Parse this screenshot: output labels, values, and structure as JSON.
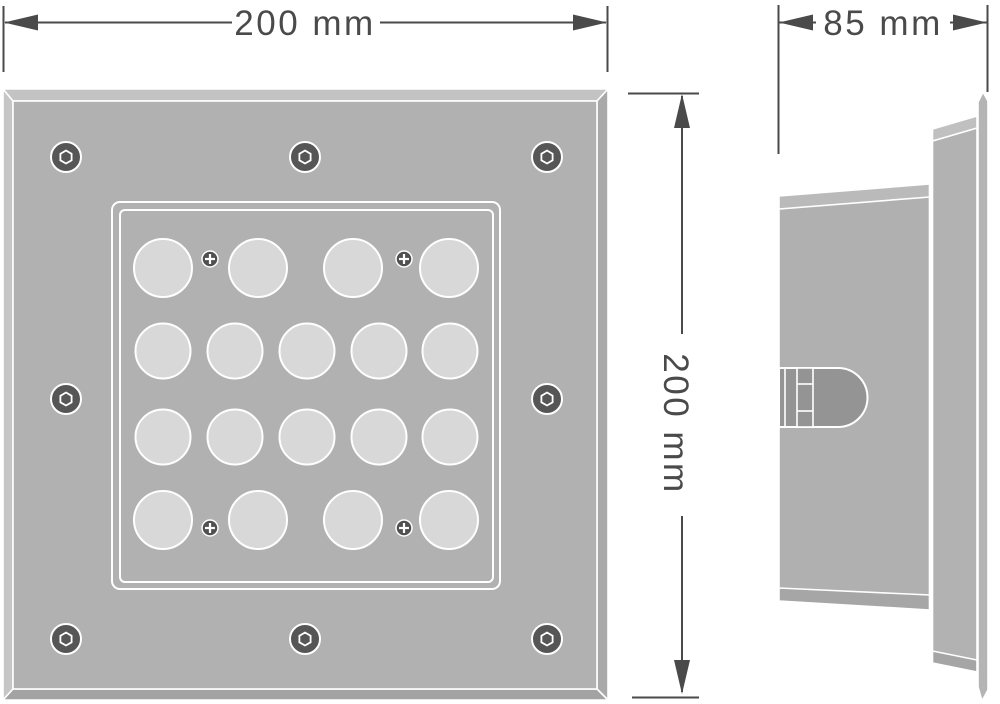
{
  "drawing": {
    "dimension_labels": {
      "front_width": "200 mm",
      "front_height": "200 mm",
      "side_depth": "85 mm"
    }
  },
  "colors": {
    "background": "#ffffff",
    "line": "#4a4a4a",
    "plate_face": "#b1b1b1",
    "band_light": "#c4c4c4",
    "band_dark": "#a5a5a5",
    "led_fill": "#d8d8d8",
    "screw_dark": "#565656",
    "phillips_dark": "#505050",
    "bullet_fill": "#949494",
    "outline_white": "#ffffff"
  },
  "front_view": {
    "corner_screws": [
      {
        "x": 66,
        "y": 157
      },
      {
        "x": 305,
        "y": 157
      },
      {
        "x": 547,
        "y": 157
      },
      {
        "x": 66,
        "y": 399
      },
      {
        "x": 547,
        "y": 399
      },
      {
        "x": 66,
        "y": 639
      },
      {
        "x": 305,
        "y": 639
      },
      {
        "x": 547,
        "y": 639
      }
    ],
    "led_rows": [
      {
        "y": 268,
        "r": 29,
        "xs": [
          163,
          258,
          353,
          449
        ]
      },
      {
        "y": 351,
        "r": 27.5,
        "xs": [
          163,
          235,
          307,
          379,
          450
        ]
      },
      {
        "y": 437,
        "r": 27.5,
        "xs": [
          163,
          235,
          307,
          379,
          450
        ]
      },
      {
        "y": 520,
        "r": 29,
        "xs": [
          163,
          258,
          353,
          449
        ]
      }
    ],
    "lens_screws": [
      {
        "x": 210,
        "y": 259
      },
      {
        "x": 404,
        "y": 259
      },
      {
        "x": 210,
        "y": 528
      },
      {
        "x": 404,
        "y": 528
      }
    ]
  }
}
